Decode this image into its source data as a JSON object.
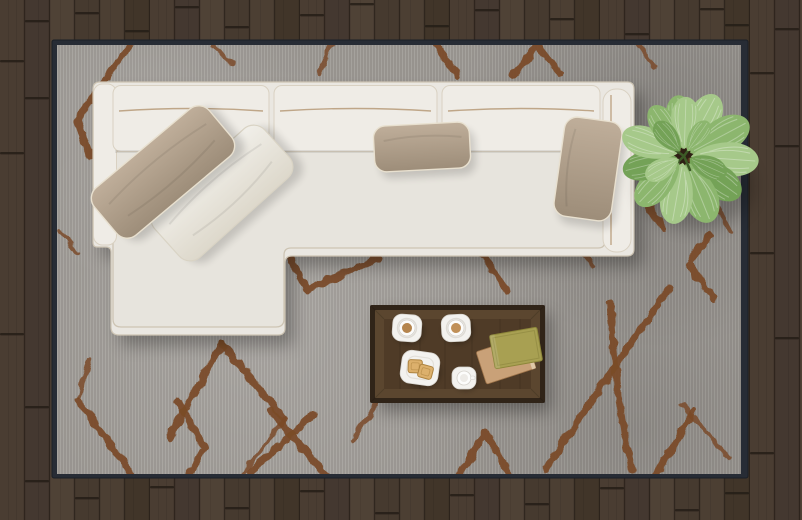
{
  "scene": {
    "description": "Top-down view of a modern living room: white L-shaped sectional sofa with taupe and white throw pillows on a gray rug with a rust-brown diamond lattice pattern, dark wood plank floor, walnut coffee table with two coffee cups, an espresso cup, a snack plate with toast, a stack of two books, and a green potted plant.",
    "objects": [
      "wood-plank-floor",
      "gray-patterned-area-rug",
      "white-sectional-sofa-with-chaise",
      "taupe-throw-pillow",
      "white-throw-pillow",
      "center-lumbar-pillow",
      "right-lumbar-pillow",
      "walnut-coffee-table",
      "coffee-cup-left",
      "coffee-cup-right",
      "snack-plate-with-toast",
      "espresso-cup",
      "book-stack",
      "potted-green-plant"
    ]
  },
  "colors": {
    "floor_seam": "#251d16",
    "plank_a": "#4a3d32",
    "plank_b": "#443830",
    "plank_c": "#4f4236",
    "plank_d": "#463a2f",
    "plank_e": "#4c3f33",
    "plank_f": "#413529",
    "rug_edge": "#272c35",
    "rug_base": "#9b9792",
    "rug_pattern": "#7a4a28",
    "sofa_body": "#eae7e1",
    "sofa_cushion": "#efece6",
    "sofa_seat": "#e7e4dd",
    "sofa_outline": "#cdc4b3",
    "sofa_piping": "#b99f7d",
    "pillow_taupe_light": "#bfae9a",
    "pillow_taupe_dark": "#9d8d79",
    "pillow_white_light": "#f1efe9",
    "pillow_white_dark": "#ddd8cb",
    "pillow_piping": "#e8e0cf",
    "table_outer": "#302418",
    "table_rim": "#5b462f",
    "table_surface": "#4f3b27",
    "saucer": "#f3f2ef",
    "coffee": "#b5854e",
    "coffee_light": "#c09058",
    "toast": "#dcb06c",
    "toast_crust": "#ad8340",
    "book_top": "#a8a052",
    "book_bottom": "#c9a178",
    "plant_light": "#a6c98a",
    "plant_mid": "#8cb66e",
    "plant_dark": "#74a257",
    "plant_soil": "#2e2014"
  }
}
